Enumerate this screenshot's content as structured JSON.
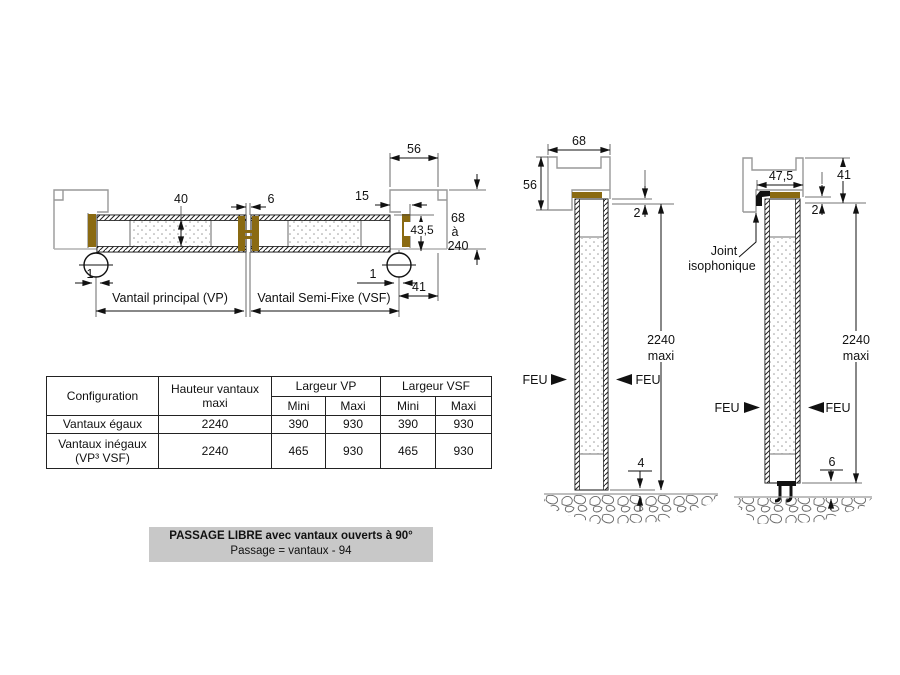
{
  "colors": {
    "seal_brown": "#8a6a12",
    "frame_gray": "#989898",
    "line_black": "#111111",
    "caption_bg": "#c8c8c8"
  },
  "plan": {
    "dim_56": "56",
    "dim_40": "40",
    "dim_6": "6",
    "dim_15": "15",
    "dim_68": "68",
    "dim_a": "à",
    "dim_240": "240",
    "dim_43_5": "43,5",
    "dim_1_left": "1",
    "dim_1_right": "1",
    "dim_41": "41",
    "label_vp": "Vantail principal (VP)",
    "label_vsf": "Vantail Semi-Fixe (VSF)"
  },
  "section_head_seal": {
    "dim_68": "68",
    "dim_56": "56",
    "dim_2": "2",
    "dim_4": "4",
    "height": "2240",
    "height_suffix": "maxi",
    "feu": "FEU"
  },
  "section_drop_seal": {
    "dim_47_5": "47,5",
    "dim_41": "41",
    "dim_2": "2",
    "dim_6": "6",
    "height": "2240",
    "height_suffix": "maxi",
    "feu": "FEU",
    "joint_label_line1": "Joint",
    "joint_label_line2": "isophonique"
  },
  "table": {
    "headers": {
      "configuration": "Configuration",
      "hauteur": "Hauteur vantaux maxi",
      "largeur_vp": "Largeur VP",
      "largeur_vsf": "Largeur VSF",
      "mini": "Mini",
      "maxi": "Maxi"
    },
    "rows": [
      {
        "config": "Vantaux égaux",
        "hauteur": "2240",
        "vp_mini": "390",
        "vp_maxi": "930",
        "vsf_mini": "390",
        "vsf_maxi": "930"
      },
      {
        "config": "Vantaux inégaux (VP³ VSF)",
        "hauteur": "2240",
        "vp_mini": "465",
        "vp_maxi": "930",
        "vsf_mini": "465",
        "vsf_maxi": "930"
      }
    ]
  },
  "caption": {
    "line1": "PASSAGE LIBRE avec vantaux ouverts à 90°",
    "line2": "Passage = vantaux - 94"
  }
}
